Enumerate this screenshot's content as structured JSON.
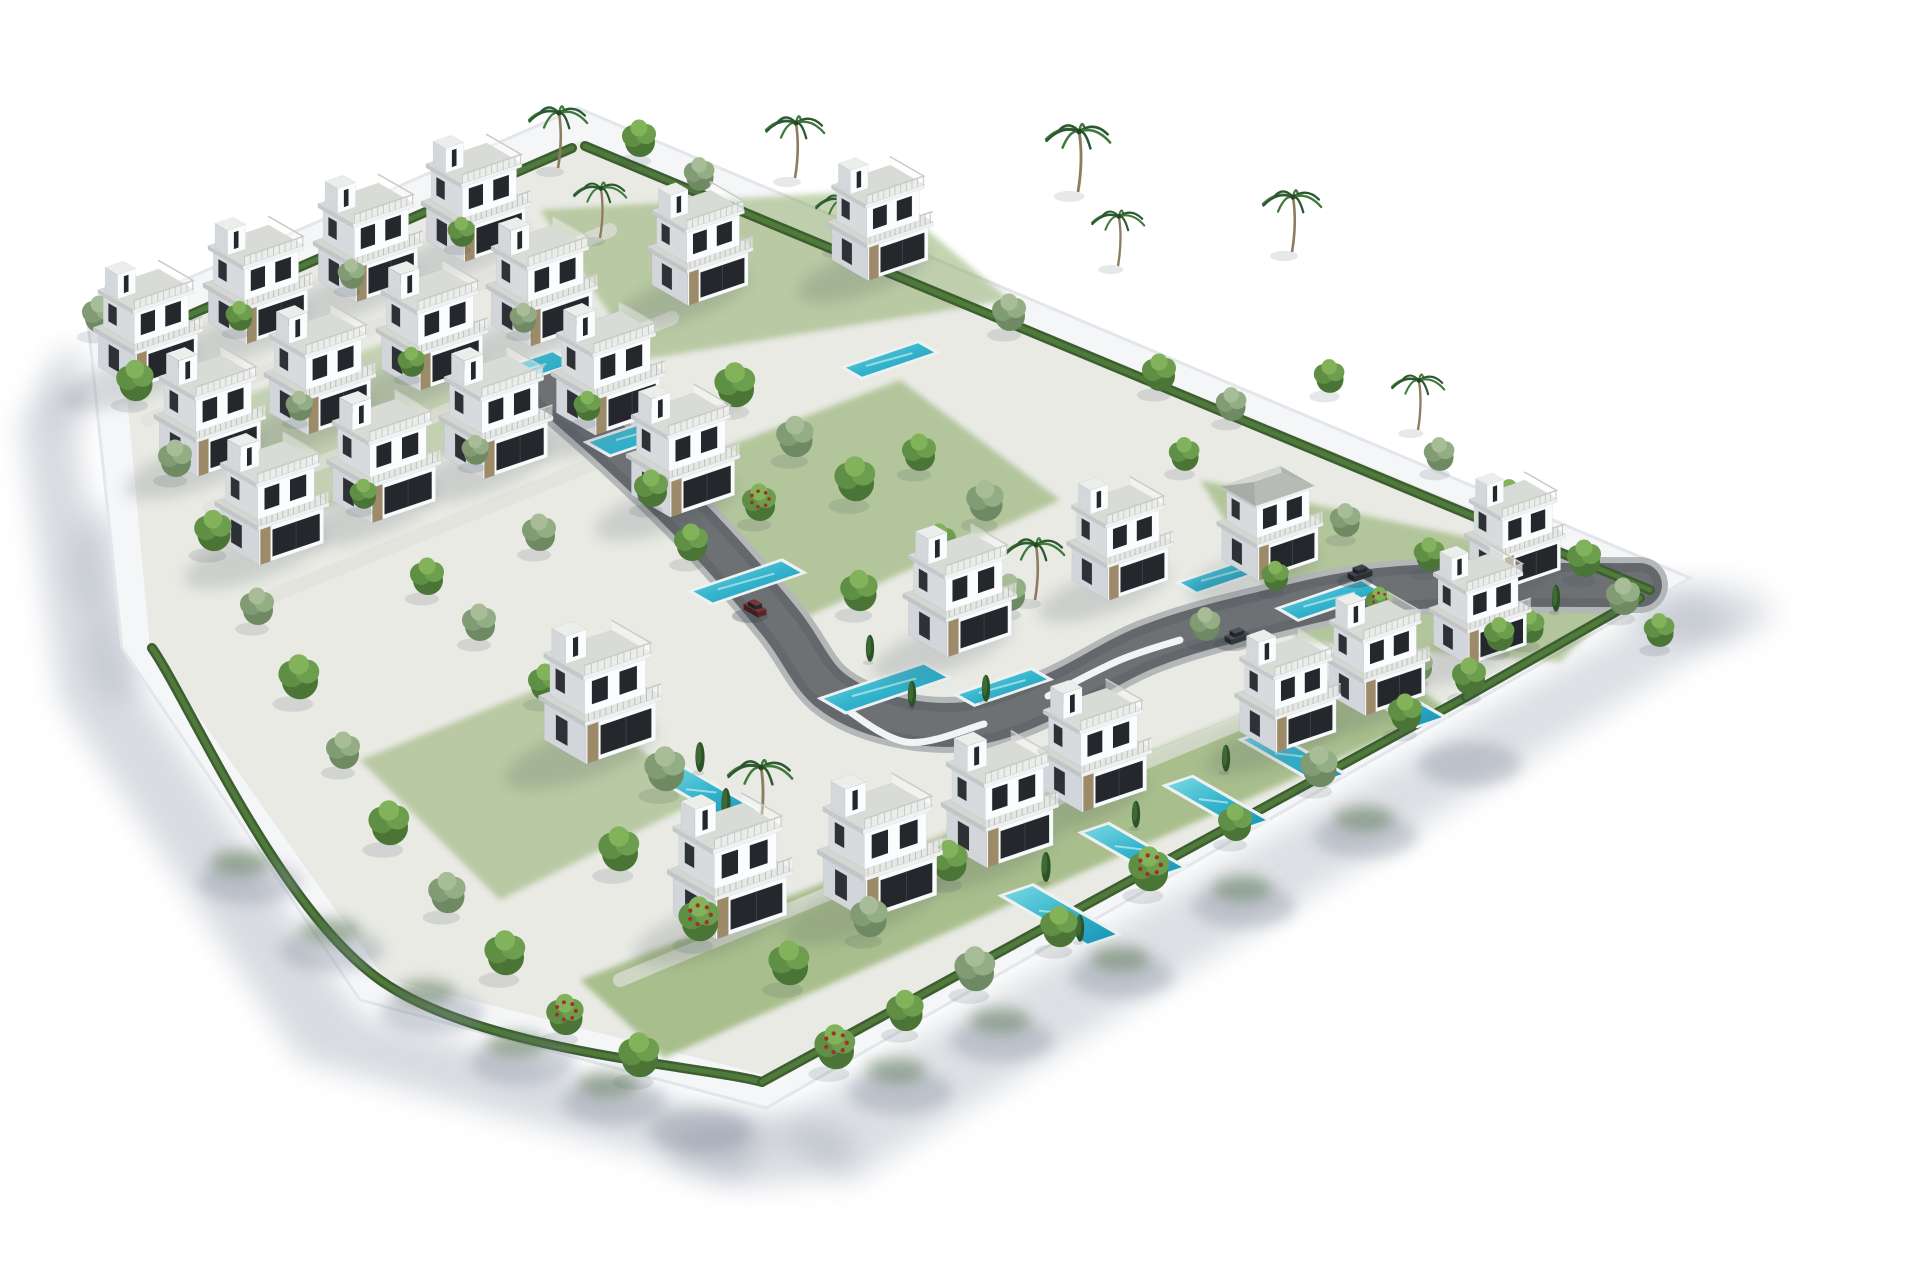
{
  "meta": {
    "subject": "Aerial 3D render of a gated residential development with white modern villas, private pools, gardens and a curving internal road",
    "render_style": "architectural visualization, white background"
  },
  "canvas": {
    "width": 1920,
    "height": 1280,
    "background": "#ffffff"
  },
  "palette": {
    "wall": "#f5f6f8",
    "wall_edge": "#e3e6ea",
    "wall_face": "#fbfcfd",
    "ground": "#e9eae4",
    "grass": "#7fa254",
    "grass_dark": "#5f7f3e",
    "walkway": "#dfe1db",
    "road": "#64686c",
    "road_edge": "#b4b7b8",
    "road_hi": "#7b7f83",
    "white_wall_curve": "#f1f3f5",
    "hedge": "#3c5e31",
    "hedge_hi": "#527d3c",
    "pool_rim": "#eef1f2",
    "pool_light": "#7ad9e2",
    "pool_mid": "#35b4cd",
    "pool_deep": "#1a95b6",
    "shadow": "#8d96a5",
    "shadow_dark": "#39424e",
    "spill_gray": "#7d8798",
    "spill_green": "#4a6a3c",
    "villa_top": "#e9ebe8",
    "villa_slab": "#d3d6d1",
    "villa_left": "#d2d5d9",
    "villa_front": "#f8fafb",
    "glass": "#24272b",
    "glass2": "#2e3236",
    "stone": "#9c8a68",
    "rail": "#c9ccc6",
    "hip_front": "#b7bbb5",
    "hip_left": "#a8aca6",
    "hip_right": "#b0b4ae",
    "trunk": "#8d7c60",
    "palm_green": "#2c5831",
    "palm_green2": "#3f7a3c",
    "tree_round": [
      "#4b7536",
      "#5f8f44",
      "#6d9e4d",
      "#82b35b"
    ],
    "tree_olive": [
      "#6f8a62",
      "#819c74",
      "#93ae85",
      "#a8bd97"
    ],
    "flower_red": "#a03226",
    "cypress": "#2d5229",
    "cypress_hi": "#3f6d33"
  },
  "plot": {
    "outer": [
      [
        88,
        322
      ],
      [
        578,
        108
      ],
      [
        1690,
        578
      ],
      [
        766,
        1108
      ],
      [
        360,
        1000
      ],
      [
        122,
        648
      ]
    ],
    "inner": [
      [
        122,
        342
      ],
      [
        582,
        140
      ],
      [
        1655,
        585
      ],
      [
        768,
        1076
      ],
      [
        384,
        978
      ],
      [
        150,
        648
      ]
    ]
  },
  "shadows": {
    "outer": [
      {
        "pts": [
          [
            60,
            360
          ],
          [
            120,
            660
          ],
          [
            360,
            1015
          ],
          [
            770,
            1125
          ],
          [
            740,
            1180
          ],
          [
            300,
            1060
          ],
          [
            60,
            700
          ],
          [
            20,
            420
          ]
        ],
        "o": 0.34
      },
      {
        "pts": [
          [
            770,
            1125
          ],
          [
            1690,
            592
          ],
          [
            1745,
            625
          ],
          [
            845,
            1185
          ]
        ],
        "o": 0.3
      }
    ],
    "corner": [
      [
        760,
        1150,
        95,
        34,
        0.33
      ],
      [
        1700,
        612,
        72,
        30,
        0.28
      ],
      [
        70,
        390,
        22,
        44,
        0.25
      ],
      [
        100,
        560,
        26,
        50,
        0.28
      ],
      [
        118,
        648,
        28,
        52,
        0.28
      ]
    ],
    "spill_gray": [
      [
        250,
        882
      ],
      [
        332,
        950
      ],
      [
        432,
        1012
      ],
      [
        522,
        1062
      ],
      [
        614,
        1102
      ],
      [
        700,
        1130
      ],
      [
        900,
        1092
      ],
      [
        1002,
        1040
      ],
      [
        1122,
        976
      ],
      [
        1244,
        906
      ],
      [
        1366,
        836
      ],
      [
        1470,
        764
      ]
    ],
    "spill_green": [
      [
        240,
        862
      ],
      [
        330,
        930
      ],
      [
        425,
        992
      ],
      [
        516,
        1044
      ],
      [
        608,
        1084
      ],
      [
        896,
        1070
      ],
      [
        1000,
        1020
      ],
      [
        1120,
        958
      ],
      [
        1242,
        888
      ],
      [
        1364,
        818
      ]
    ]
  },
  "grass": [
    {
      "pts": [
        [
          580,
          980
        ],
        [
          1380,
          660
        ],
        [
          1448,
          710
        ],
        [
          664,
          1058
        ]
      ],
      "o": 0.6
    },
    {
      "pts": [
        [
          640,
          480
        ],
        [
          900,
          380
        ],
        [
          1060,
          500
        ],
        [
          800,
          620
        ]
      ],
      "o": 0.5
    },
    {
      "pts": [
        [
          540,
          210
        ],
        [
          880,
          190
        ],
        [
          1010,
          300
        ],
        [
          640,
          360
        ]
      ],
      "o": 0.45
    },
    {
      "pts": [
        [
          1200,
          480
        ],
        [
          1480,
          540
        ],
        [
          1620,
          602
        ],
        [
          1560,
          662
        ],
        [
          1300,
          642
        ]
      ],
      "o": 0.5
    },
    {
      "pts": [
        [
          180,
          420
        ],
        [
          420,
          330
        ],
        [
          520,
          420
        ],
        [
          300,
          520
        ]
      ],
      "o": 0.35
    },
    {
      "pts": [
        [
          360,
          760
        ],
        [
          560,
          680
        ],
        [
          700,
          800
        ],
        [
          500,
          900
        ]
      ],
      "o": 0.45
    }
  ],
  "walkways": [
    [
      [
        148,
        420
      ],
      [
        610,
        230
      ]
    ],
    [
      [
        210,
        508
      ],
      [
        672,
        318
      ]
    ],
    [
      [
        272,
        596
      ],
      [
        734,
        406
      ]
    ],
    [
      [
        620,
        980
      ],
      [
        1380,
        665
      ]
    ]
  ],
  "road": {
    "points": [
      [
        548,
        388
      ],
      [
        620,
        452
      ],
      [
        700,
        530
      ],
      [
        780,
        622
      ],
      [
        830,
        690
      ],
      [
        900,
        720
      ],
      [
        980,
        722
      ],
      [
        1060,
        692
      ],
      [
        1150,
        646
      ],
      [
        1260,
        614
      ],
      [
        1400,
        588
      ],
      [
        1640,
        585
      ]
    ],
    "retaining": [
      [
        [
          836,
          702
        ],
        [
          906,
          742
        ],
        [
          984,
          724
        ]
      ],
      [
        [
          1048,
          696
        ],
        [
          1120,
          660
        ],
        [
          1180,
          640
        ]
      ]
    ],
    "driveway": [
      [
        1460,
        580
      ],
      [
        1524,
        558
      ]
    ]
  },
  "hedges": [
    [
      [
        152,
        648
      ],
      [
        380,
        980
      ],
      [
        762,
        1082
      ]
    ],
    [
      [
        762,
        1082
      ],
      [
        1466,
        697
      ]
    ],
    [
      [
        1466,
        697
      ],
      [
        1640,
        598
      ]
    ],
    [
      [
        128,
        342
      ],
      [
        572,
        148
      ]
    ],
    [
      [
        585,
        146
      ],
      [
        1650,
        590
      ]
    ]
  ],
  "pools": [
    {
      "x": 520,
      "y": 372,
      "u": 42,
      "v": 12
    },
    {
      "x": 648,
      "y": 432,
      "u": 48,
      "v": 13
    },
    {
      "x": 747,
      "y": 582,
      "u": 44,
      "v": 12
    },
    {
      "x": 885,
      "y": 688,
      "u": 50,
      "v": 14
    },
    {
      "x": 890,
      "y": 360,
      "u": 36,
      "v": 10
    },
    {
      "x": 1330,
      "y": 600,
      "u": 40,
      "v": 11
    },
    {
      "x": 1225,
      "y": 575,
      "u": 36,
      "v": 10
    },
    {
      "x": 1003,
      "y": 687,
      "u": 36,
      "v": 10
    },
    {
      "x": 705,
      "y": 793,
      "u": 13,
      "v": 46
    },
    {
      "x": 1060,
      "y": 915,
      "u": 14,
      "v": 52
    },
    {
      "x": 1133,
      "y": 850,
      "u": 12,
      "v": 46
    },
    {
      "x": 1217,
      "y": 803,
      "u": 12,
      "v": 46
    },
    {
      "x": 1293,
      "y": 757,
      "u": 12,
      "v": 46
    },
    {
      "x": 1393,
      "y": 700,
      "u": 12,
      "v": 46
    }
  ],
  "villas": [
    [
      148,
      367,
      0.98
    ],
    [
      258,
      323,
      0.98
    ],
    [
      368,
      281,
      0.98
    ],
    [
      476,
      241,
      0.98
    ],
    [
      210,
      455,
      1.0
    ],
    [
      320,
      413,
      1.0
    ],
    [
      432,
      369,
      1.0
    ],
    [
      542,
      325,
      1.0
    ],
    [
      272,
      543,
      1.02
    ],
    [
      384,
      501,
      1.02
    ],
    [
      496,
      457,
      1.02
    ],
    [
      608,
      413,
      1.02
    ],
    [
      700,
      285,
      0.95
    ],
    [
      880,
      260,
      0.95
    ],
    [
      683,
      495,
      1.02
    ],
    [
      960,
      635,
      1.02
    ],
    [
      1120,
      580,
      0.95
    ],
    [
      1270,
      560,
      0.95,
      "hip"
    ],
    [
      600,
      740,
      1.1
    ],
    [
      730,
      915,
      1.12
    ],
    [
      880,
      895,
      1.12
    ],
    [
      1000,
      845,
      1.05
    ],
    [
      1095,
      790,
      1.02
    ],
    [
      1515,
      570,
      0.9
    ],
    [
      1480,
      645,
      0.92
    ],
    [
      1377,
      695,
      0.95
    ],
    [
      1288,
      732,
      0.95
    ]
  ],
  "trees": [
    [
      100,
      332,
      1,
      "o"
    ],
    [
      136,
      400,
      1.1,
      "r"
    ],
    [
      176,
      476,
      1,
      "o"
    ],
    [
      214,
      550,
      1.1,
      "r"
    ],
    [
      258,
      624,
      1,
      "o"
    ],
    [
      300,
      698,
      1.2,
      "r"
    ],
    [
      344,
      768,
      1,
      "o"
    ],
    [
      390,
      844,
      1.2,
      "r"
    ],
    [
      448,
      912,
      1.1,
      "o"
    ],
    [
      506,
      974,
      1.2,
      "r"
    ],
    [
      566,
      1034,
      1.1,
      "f"
    ],
    [
      640,
      1076,
      1.2,
      "r"
    ],
    [
      836,
      1068,
      1.2,
      "f"
    ],
    [
      906,
      1030,
      1.1,
      "r"
    ],
    [
      976,
      990,
      1.2,
      "o"
    ],
    [
      1060,
      946,
      1.1,
      "r"
    ],
    [
      1150,
      890,
      1.2,
      "f"
    ],
    [
      1236,
      840,
      1,
      "r"
    ],
    [
      1320,
      786,
      1.1,
      "o"
    ],
    [
      1406,
      730,
      1,
      "r"
    ],
    [
      1470,
      694,
      1,
      "r"
    ],
    [
      640,
      156,
      1,
      "r"
    ],
    [
      700,
      190,
      0.9,
      "o"
    ],
    [
      870,
      252,
      1,
      "r"
    ],
    [
      1010,
      330,
      1,
      "o"
    ],
    [
      1160,
      390,
      1,
      "r"
    ],
    [
      1232,
      420,
      0.9,
      "o"
    ],
    [
      1330,
      392,
      0.9,
      "r"
    ],
    [
      1440,
      470,
      0.9,
      "o"
    ],
    [
      1510,
      512,
      0.9,
      "r"
    ],
    [
      1585,
      576,
      1,
      "r"
    ],
    [
      1624,
      614,
      1,
      "o"
    ],
    [
      1660,
      646,
      0.9,
      "r"
    ],
    [
      1530,
      642,
      0.9,
      "r"
    ],
    [
      736,
      406,
      1.2,
      "r"
    ],
    [
      796,
      456,
      1.1,
      "o"
    ],
    [
      856,
      500,
      1.2,
      "r"
    ],
    [
      920,
      470,
      1,
      "r"
    ],
    [
      986,
      520,
      1.1,
      "o"
    ],
    [
      760,
      520,
      1,
      "f"
    ],
    [
      692,
      560,
      1,
      "r"
    ],
    [
      940,
      560,
      1,
      "r"
    ],
    [
      1010,
      610,
      1,
      "o"
    ],
    [
      860,
      610,
      1.1,
      "r"
    ],
    [
      240,
      330,
      0.8,
      "r"
    ],
    [
      352,
      288,
      0.8,
      "o"
    ],
    [
      462,
      246,
      0.8,
      "r"
    ],
    [
      300,
      420,
      0.8,
      "o"
    ],
    [
      412,
      376,
      0.8,
      "r"
    ],
    [
      524,
      332,
      0.8,
      "o"
    ],
    [
      364,
      508,
      0.8,
      "r"
    ],
    [
      476,
      464,
      0.8,
      "o"
    ],
    [
      588,
      420,
      0.8,
      "r"
    ],
    [
      428,
      594,
      1,
      "r"
    ],
    [
      540,
      550,
      1,
      "o"
    ],
    [
      652,
      506,
      1,
      "r"
    ],
    [
      1185,
      470,
      0.9,
      "r"
    ],
    [
      1346,
      536,
      0.9,
      "o"
    ],
    [
      1430,
      570,
      0.9,
      "r"
    ],
    [
      1500,
      650,
      0.9,
      "r"
    ],
    [
      1380,
      616,
      0.8,
      "f"
    ],
    [
      1276,
      590,
      0.8,
      "r"
    ],
    [
      1206,
      640,
      0.9,
      "o"
    ],
    [
      1300,
      700,
      0.9,
      "r"
    ],
    [
      1420,
      680,
      0.8,
      "o"
    ],
    [
      666,
      790,
      1.2,
      "o"
    ],
    [
      620,
      870,
      1.2,
      "r"
    ],
    [
      700,
      940,
      1.2,
      "f"
    ],
    [
      790,
      984,
      1.2,
      "r"
    ],
    [
      870,
      936,
      1.1,
      "o"
    ],
    [
      950,
      880,
      1.1,
      "r"
    ],
    [
      546,
      700,
      1,
      "r"
    ],
    [
      480,
      640,
      1,
      "o"
    ],
    [
      700,
      770,
      1,
      "c"
    ],
    [
      726,
      816,
      1,
      "c"
    ],
    [
      1046,
      880,
      1,
      "c"
    ],
    [
      1080,
      940,
      0.9,
      "c"
    ],
    [
      1136,
      826,
      0.9,
      "c"
    ],
    [
      1226,
      770,
      0.9,
      "c"
    ],
    [
      1310,
      726,
      0.9,
      "c"
    ],
    [
      870,
      660,
      0.9,
      "c"
    ],
    [
      912,
      706,
      0.9,
      "c"
    ],
    [
      530,
      396,
      0.8,
      "c"
    ],
    [
      1400,
      660,
      0.8,
      "c"
    ],
    [
      986,
      700,
      0.9,
      "c"
    ],
    [
      1556,
      610,
      0.9,
      "c"
    ],
    [
      558,
      168,
      1,
      "p"
    ],
    [
      600,
      238,
      0.9,
      "p"
    ],
    [
      795,
      178,
      1,
      "p"
    ],
    [
      842,
      250,
      0.9,
      "p"
    ],
    [
      1078,
      192,
      1.1,
      "p"
    ],
    [
      1118,
      266,
      0.9,
      "p"
    ],
    [
      1292,
      252,
      1,
      "p"
    ],
    [
      1418,
      430,
      0.9,
      "p"
    ],
    [
      760,
      828,
      1.1,
      "p"
    ],
    [
      1035,
      600,
      1,
      "p"
    ]
  ],
  "cars": [
    {
      "x": 755,
      "y": 612,
      "axis": "v",
      "top": "#7a3336",
      "front": "#5d2426",
      "left": "#471b1d"
    },
    {
      "x": 1237,
      "y": 640,
      "axis": "u",
      "top": "#4a5056",
      "front": "#33383d",
      "left": "#24282c"
    },
    {
      "x": 1360,
      "y": 577,
      "axis": "u",
      "top": "#3e444a",
      "front": "#2b3036",
      "left": "#1e2226"
    }
  ]
}
